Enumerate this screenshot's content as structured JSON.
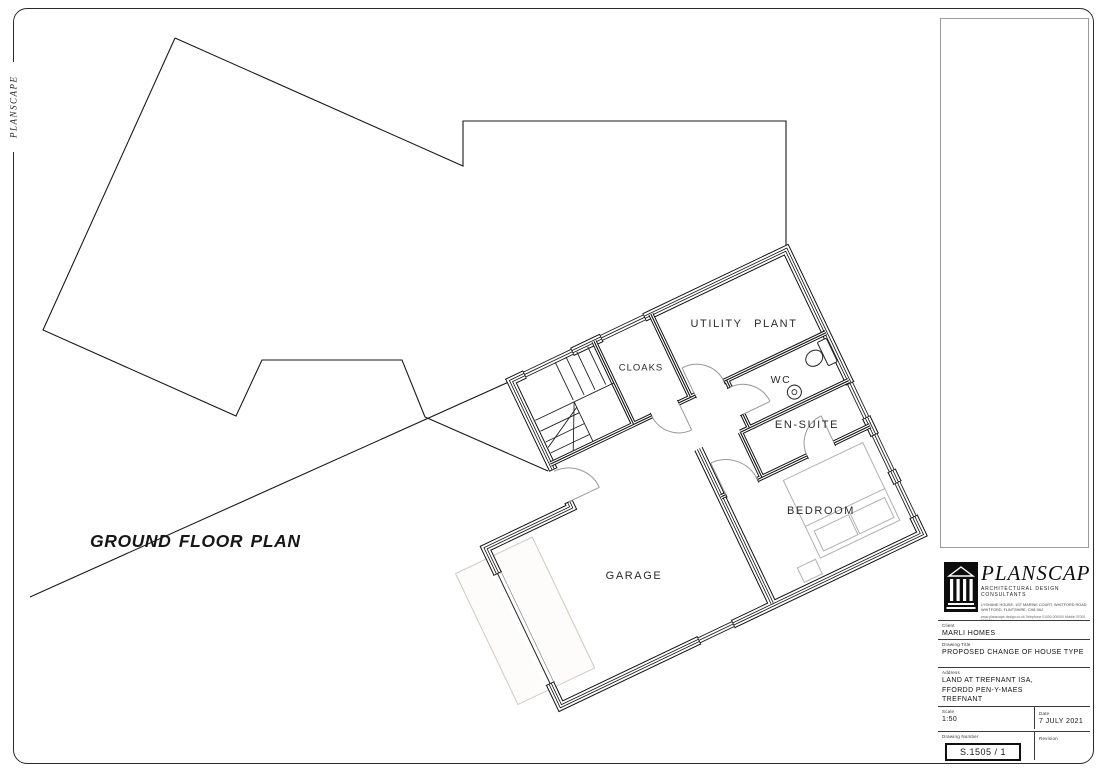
{
  "page": {
    "side_label": "PLANSCAPE",
    "plan_title": "GROUND FLOOR PLAN"
  },
  "rooms": [
    {
      "name": "UTILITY PLANT"
    },
    {
      "name": "CLOAKS"
    },
    {
      "name": "WC"
    },
    {
      "name": "EN-SUITE"
    },
    {
      "name": "BEDROOM"
    },
    {
      "name": "GARAGE"
    }
  ],
  "title_block": {
    "brand": {
      "name": "PLANSCAPE",
      "tagline": "ARCHITECTURAL DESIGN CONSULTANTS",
      "address_line1": "LYSHANE HOUSE, 1ST MARINE COURT, WHITFORD ROAD",
      "address_line2": "WHITFORD, FLINTSHIRE, CH8 9AJ",
      "contact_line": "www.planscape-design.co.uk    Telephone 01000 000000    Mobile 07000 000000"
    },
    "fields": {
      "client_label": "Client",
      "client": "MARLI HOMES",
      "job_label": "Drawing Title",
      "job": "PROPOSED CHANGE OF HOUSE TYPE",
      "address_label": "Address",
      "address_lines": [
        "LAND AT TREFNANT ISA,",
        "FFORDD PEN-Y-MAES",
        "TREFNANT"
      ],
      "scale_label": "Scale",
      "scale": "1:50",
      "date_label": "Date",
      "date": "7 JULY 2021",
      "number_label": "Drawing Number",
      "number": "S.1505 / 1",
      "revision_label": "Revision",
      "revision": ""
    }
  },
  "colors": {
    "line": "#1a1a1a",
    "door_arc": "#999999",
    "furniture": "#b0b0b0",
    "driveway_pad": "#cfcabf"
  }
}
